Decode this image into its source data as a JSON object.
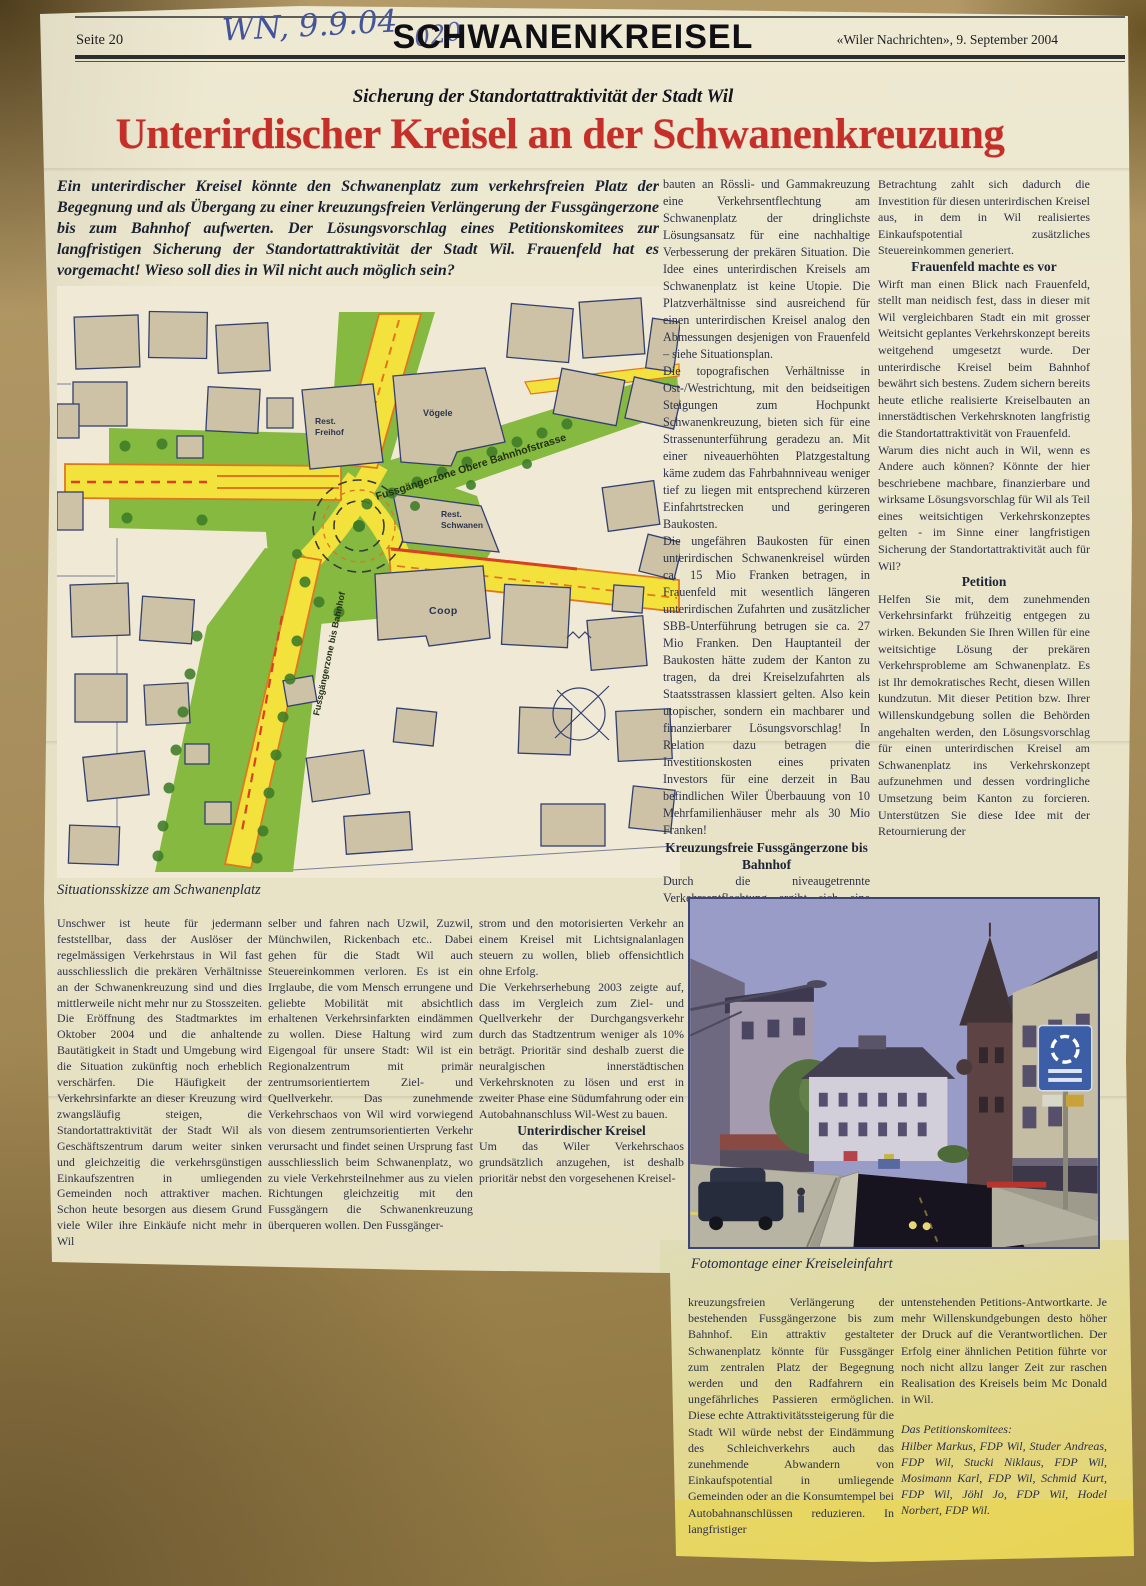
{
  "header": {
    "page": "Seite 20",
    "handwritten_date": "WN, 9.9.04",
    "handwritten_number": "020",
    "section_title": "SCHWANENKREISEL",
    "source": "«Wiler Nachrichten», 9. September 2004"
  },
  "headline": {
    "kicker": "Sicherung der Standortattraktivität der Stadt Wil",
    "title": "Unterirdischer Kreisel an der Schwanenkreuzung",
    "lead": "Ein unterirdischer Kreisel könnte den Schwanenplatz zum verkehrsfreien Platz der Begegnung und als Übergang zu einer kreuzungsfreien Verlängerung der Fussgängerzone bis zum Bahnhof aufwerten. Der Lösungsvorschlag eines Petitionskomitees zur langfristigen Sicherung der Standortattraktivität der Stadt Wil. Frauenfeld hat es vorgemacht! Wieso soll dies in Wil nicht auch möglich sein?"
  },
  "map": {
    "caption": "Situationsskizze am Schwanenplatz",
    "labels": {
      "voegele": "Vögele",
      "freihof_1": "Rest.",
      "freihof_2": "Freihof",
      "schwanen_1": "Rest.",
      "schwanen_2": "Schwanen",
      "coop": "Coop",
      "fussgaengerzone_obere": "Fussgängerzone Obere Bahnhofstrasse",
      "fussgaengerzone_bahnhof": "Fussgängerzone bis Bahnhof"
    }
  },
  "photo": {
    "caption": "Fotomontage einer Kreiseleinfahrt"
  },
  "article": {
    "col_mid": {
      "p1": "bauten an Rössli- und Gammakreuzung eine Verkehrsentflechtung am Schwanenplatz der dringlichste Lösungsansatz für eine nachhaltige Verbesserung der prekären Situation. Die Idee eines unterirdischen Kreisels am Schwanenplatz ist keine Utopie. Die Platzverhältnisse sind ausreichend für einen unterirdischen Kreisel analog den Abmessungen desjenigen von Frauenfeld – siehe Situationsplan.",
      "p2": "Die topografischen Verhältnisse in Ost-/Westrichtung, mit den beidseitigen Steigungen zum Hochpunkt Schwanenkreuzung, bieten sich für eine Strassenunterführung geradezu an. Mit einer niveauerhöhten Platzgestaltung käme zudem das Fahrbahnniveau weniger tief zu liegen mit entsprechend kürzeren Einfahrtstrecken und geringeren Baukosten.",
      "p3": "Die ungefähren Baukosten für einen unterirdischen Schwanenkreisel würden ca. 15 Mio Franken betragen, in Frauenfeld mit wesentlich längeren unterirdischen Zufahrten und zusätzlicher SBB-Unterführung betrugen sie ca. 27 Mio Franken. Den Hauptanteil der Baukosten hätte zudem der Kanton zu tragen, da drei Kreiselzufahrten als Staatsstrassen klassiert gelten. Also kein utopischer, sondern ein machbarer und finanzierbarer Lösungsvorschlag! In Relation dazu betragen die Investitionskosten eines privaten Investors für eine derzeit in Bau befindlichen Wiler Überbauung von 10 Mehrfamilienhäuser mehr als 30 Mio Franken!",
      "h1": "Kreuzungsfreie Fussgängerzone bis Bahnhof",
      "p4": "Durch die niveaugetrennte Verkehrsentflechtung ergibt sich eine erhebliche Leistungssteigerung an diesem Verkehrsknoten mit gleichzeitig einer"
    },
    "col_right": {
      "p1": "Betrachtung zahlt sich dadurch die Investition für diesen unterirdischen Kreisel aus, in dem in Wil realisiertes Einkaufspotential zusätzliches Steuereinkommen generiert.",
      "h1": "Frauenfeld machte es vor",
      "p2": "Wirft man einen Blick nach Frauenfeld, stellt man neidisch fest, dass in dieser mit Wil vergleichbaren Stadt ein mit grosser Weitsicht geplantes Verkehrskonzept bereits weitgehend umgesetzt wurde. Der unterirdische Kreisel beim Bahnhof bewährt sich bestens. Zudem sichern bereits heute etliche realisierte Kreiselbauten an innerstädtischen Verkehrsknoten langfristig die Standortattraktivität von Frauenfeld.",
      "p3": "Warum dies nicht auch in Wil, wenn es Andere auch können? Könnte der hier beschriebene machbare, finanzierbare und wirksame Lösungsvorschlag für Wil als Teil eines weitsichtigen Verkehrskonzeptes gelten - im Sinne einer langfristigen Sicherung der Standortattraktivität auch für Wil?",
      "h2": "Petition",
      "p4": "Helfen Sie mit, dem zunehmenden Verkehrsinfarkt frühzeitig entgegen zu wirken. Bekunden Sie Ihren Willen für eine weitsichtige Lösung der prekären Verkehrsprobleme am Schwanenplatz. Es ist Ihr demokratisches Recht, diesen Willen kundzutun. Mit dieser Petition bzw. Ihrer Willenskundgebung sollen die Behörden angehalten werden, den Lösungsvorschlag für einen unterirdischen Kreisel am Schwanenplatz ins Verkehrskonzept aufzunehmen und dessen vordringliche Umsetzung beim Kanton zu forcieren. Unterstützen Sie diese Idee mit der Retournierung der"
    },
    "col_b1": {
      "p1": "Unschwer ist heute für jedermann feststellbar, dass der Auslöser der regelmässigen Verkehrstaus in Wil fast ausschliesslich die prekären Verhältnisse an der Schwanenkreuzung sind und dies mittlerweile nicht mehr nur zu Stosszeiten. Die Eröffnung des Stadtmarktes im Oktober 2004 und die anhaltende Bautätigkeit in Stadt und Umgebung wird die Situation zukünftig noch erheblich verschärfen. Die Häufigkeit der Verkehrsinfarkte an dieser Kreuzung wird zwangsläufig steigen, die Standortattraktivität der Stadt Wil als Geschäftszentrum darum weiter sinken und gleichzeitig die verkehrsgünstigen Einkaufszentren in umliegenden Gemeinden noch attraktiver machen. Schon heute besorgen aus diesem Grund viele Wiler ihre Einkäufe nicht mehr in Wil"
    },
    "col_b2": {
      "p1": "selber und fahren nach Uzwil, Zuzwil, Münchwilen, Rickenbach etc.. Dabei gehen für die Stadt Wil auch Steuereinkommen verloren. Es ist ein Irrglaube, die vom Mensch errungene und geliebte Mobilität mit absichtlich erhaltenen Verkehrsinfarkten eindämmen zu wollen. Diese Haltung wird zum Eigengoal für unsere Stadt: Wil ist ein Regionalzentrum mit primär zentrumsorientiertem Ziel- und Quellverkehr. Das zunehmende Verkehrschaos von Wil wird vorwiegend von diesem zentrumsorientierten Verkehr verursacht und findet seinen Ursprung fast ausschliesslich beim Schwanenplatz, wo zu viele Verkehrsteilnehmer aus zu vielen Richtungen gleichzeitig mit den Fussgängern die Schwanenkreuzung überqueren wollen. Den Fussgänger-"
    },
    "col_b3": {
      "p1": "strom und den motorisierten Verkehr an einem Kreisel mit Lichtsignalanlagen steuern zu wollen, blieb offensichtlich ohne Erfolg.",
      "p2": "Die Verkehrserhebung 2003 zeigte auf, dass im Vergleich zum Ziel- und Quellverkehr der Durchgangsverkehr durch das Stadtzentrum weniger als 10% beträgt. Prioritär sind deshalb zuerst die neuralgischen innerstädtischen Verkehrsknoten zu lösen und erst in zweiter Phase eine Südumfahrung oder ein Autobahnanschluss Wil-West zu bauen.",
      "h1": "Unterirdischer Kreisel",
      "p3": "Um das Wiler Verkehrschaos grundsätzlich anzugehen, ist deshalb prioritär nebst den vorgesehenen Kreisel-"
    },
    "col_e1": {
      "p1": "kreuzungsfreien Verlängerung der bestehenden Fussgängerzone bis zum Bahnhof. Ein attraktiv gestalteter Schwanenplatz könnte für Fussgänger zum zentralen Platz der Begegnung werden und den Radfahrern ein ungefährliches Passieren ermöglichen. Diese echte Attraktivitätssteigerung für die Stadt Wil würde nebst der Eindämmung des Schleichverkehrs auch das zunehmende Abwandern von Einkaufspotential in umliegende Gemeinden oder an die Konsumtempel bei Autobahnanschlüssen reduzieren. In langfristiger"
    },
    "col_e2": {
      "p1": "untenstehenden Petitions-Antwortkarte. Je mehr Willenskundgebungen desto höher der Druck auf die Verantwortlichen. Der Erfolg einer ähnlichen Petition führte vor noch nicht allzu langer Zeit zur raschen Realisation des Kreisels beim Mc Donald in Wil.",
      "credit_title": "Das Petitionskomitees:",
      "credit_names": "Hilber Markus, FDP Wil, Studer Andreas, FDP Wil, Stucki Niklaus, FDP Wil, Mosimann Karl, FDP Wil, Schmid Kurt, FDP Wil, Jöhl Jo, FDP Wil, Hodel Norbert, FDP Wil."
    }
  },
  "colors": {
    "headline_red": "#c43029",
    "ink": "#2c3147",
    "handwriting_blue": "#44549b",
    "paper": "#e9e4c9",
    "cardboard": "#a78e5c",
    "map_green": "#86b93f",
    "map_road_yellow": "#f3e23b",
    "map_road_orange": "#e0771f",
    "map_building": "#cdc1a6",
    "map_outline": "#33406e",
    "photo_sky": "#9a9cc8"
  }
}
